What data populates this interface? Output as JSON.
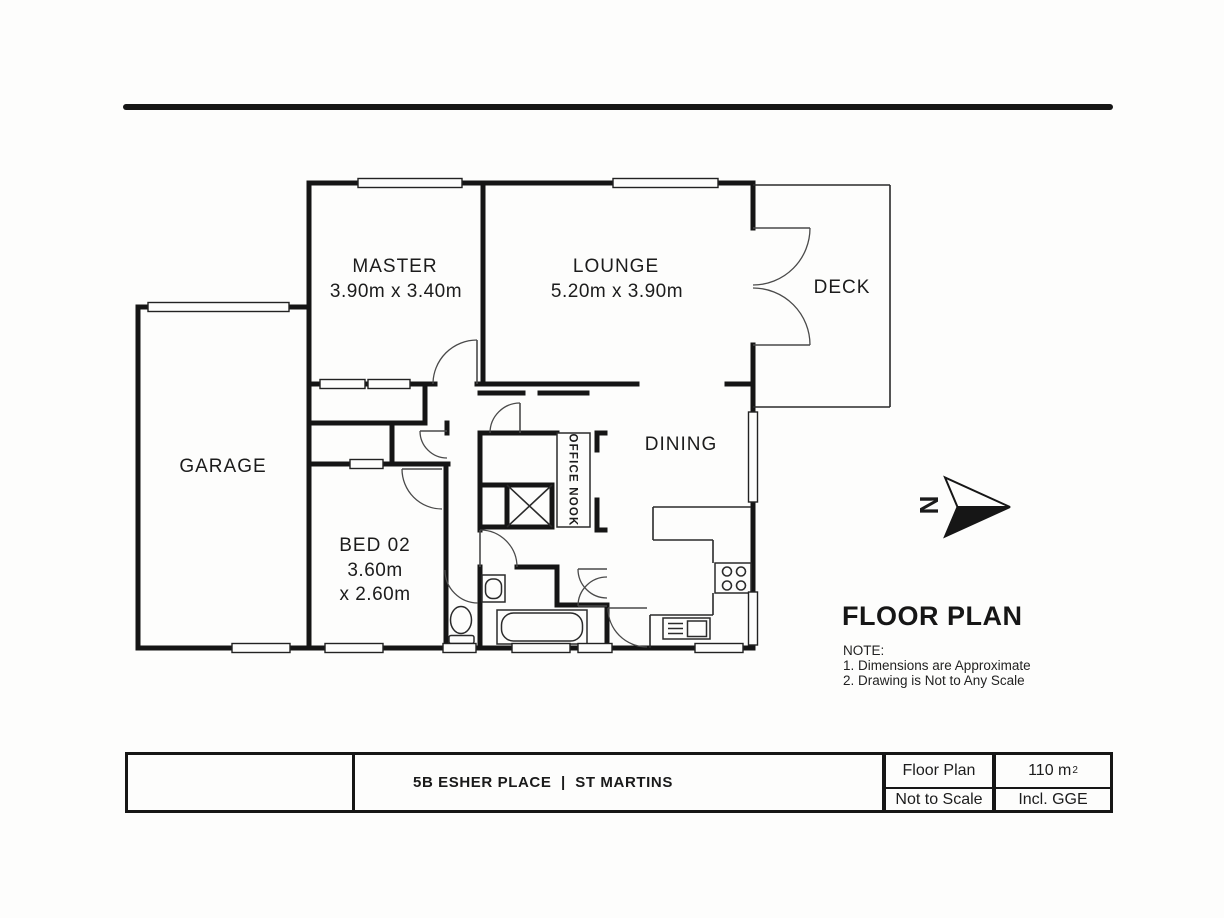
{
  "colors": {
    "ink": "#1b1b1b",
    "wall": "#151515",
    "paper": "#fdfdfc"
  },
  "plan": {
    "rooms": {
      "master": {
        "name": "MASTER",
        "dims": "3.90m x 3.40m"
      },
      "lounge": {
        "name": "LOUNGE",
        "dims": "5.20m x 3.90m"
      },
      "deck": {
        "name": "DECK"
      },
      "garage": {
        "name": "GARAGE"
      },
      "dining": {
        "name": "DINING"
      },
      "bed02": {
        "name": "BED 02",
        "dims_line1": "3.60m",
        "dims_line2": "x 2.60m"
      },
      "office_nook": {
        "name": "OFFICE NOOK"
      }
    },
    "north_label": "N"
  },
  "annotation": {
    "heading": "FLOOR PLAN",
    "note_title": "NOTE:",
    "notes": [
      "1. Dimensions are Approximate",
      "2. Drawing is Not to Any Scale"
    ]
  },
  "title_block": {
    "address": "5B ESHER PLACE  |  ST MARTINS",
    "doc_type": "Floor Plan",
    "scale": "Not to Scale",
    "area": "110 m",
    "area_sup": "2",
    "area_note": "Incl. GGE"
  }
}
